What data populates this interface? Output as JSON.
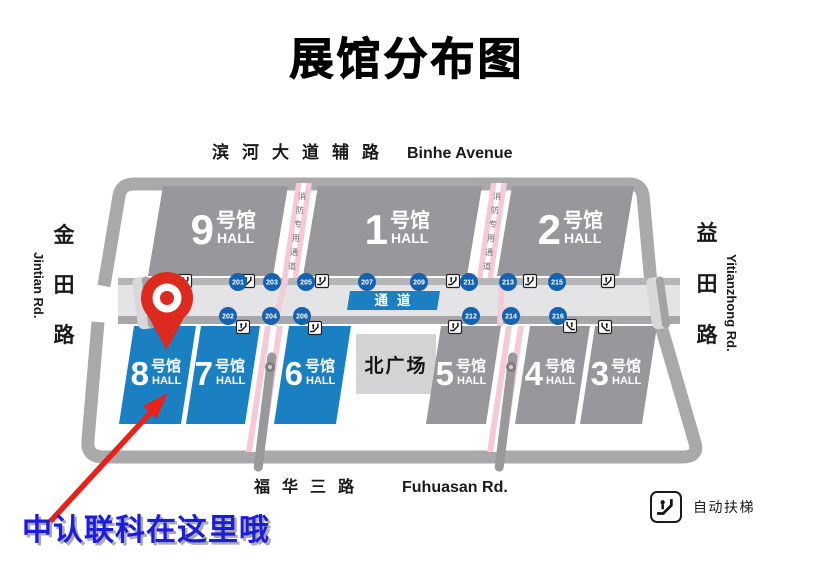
{
  "title": "展馆分布图",
  "roads": {
    "top": {
      "zh": "滨河大道辅路",
      "en": "Binhe Avenue"
    },
    "bottom": {
      "zh": "福华三路",
      "en": "Fuhuasan Rd."
    },
    "left": {
      "chars": [
        "金",
        "田",
        "路"
      ],
      "en": "Jintian Rd."
    },
    "right": {
      "chars": [
        "益",
        "田",
        "路"
      ],
      "en": "Yitianzhong Rd."
    }
  },
  "halls": {
    "top": [
      "9",
      "1",
      "2"
    ],
    "bottom": [
      "8",
      "7",
      "6",
      "5",
      "4",
      "3"
    ]
  },
  "hall_suffix": "号馆",
  "hall_sub": "HALL",
  "plaza": "北广场",
  "corridor_label": "通道",
  "gates": {
    "top": [
      "201",
      "203",
      "205",
      "207",
      "209",
      "211",
      "213",
      "215"
    ],
    "bottom": [
      "202",
      "204",
      "206",
      "212",
      "214",
      "216"
    ]
  },
  "fire_lane": {
    "chars": [
      "消",
      "防",
      "专",
      "用",
      "通",
      "道"
    ]
  },
  "legend": {
    "escalator": "自动扶梯"
  },
  "annotation": "中认联科在这里哦",
  "colors": {
    "hall_gray": "#98989c",
    "hall_blue": "#1a80c2",
    "gate_blue": "#1563b0",
    "lane_pink": "#f7c9d5",
    "pin_red": "#dd2a1f",
    "arrow_red": "#e8221a",
    "annotation_blue": "#1c1be2",
    "corridor_gray": "#e4e4e6",
    "outline_gray": "#a9a9ac",
    "plaza_gray": "#d3d3d5"
  }
}
